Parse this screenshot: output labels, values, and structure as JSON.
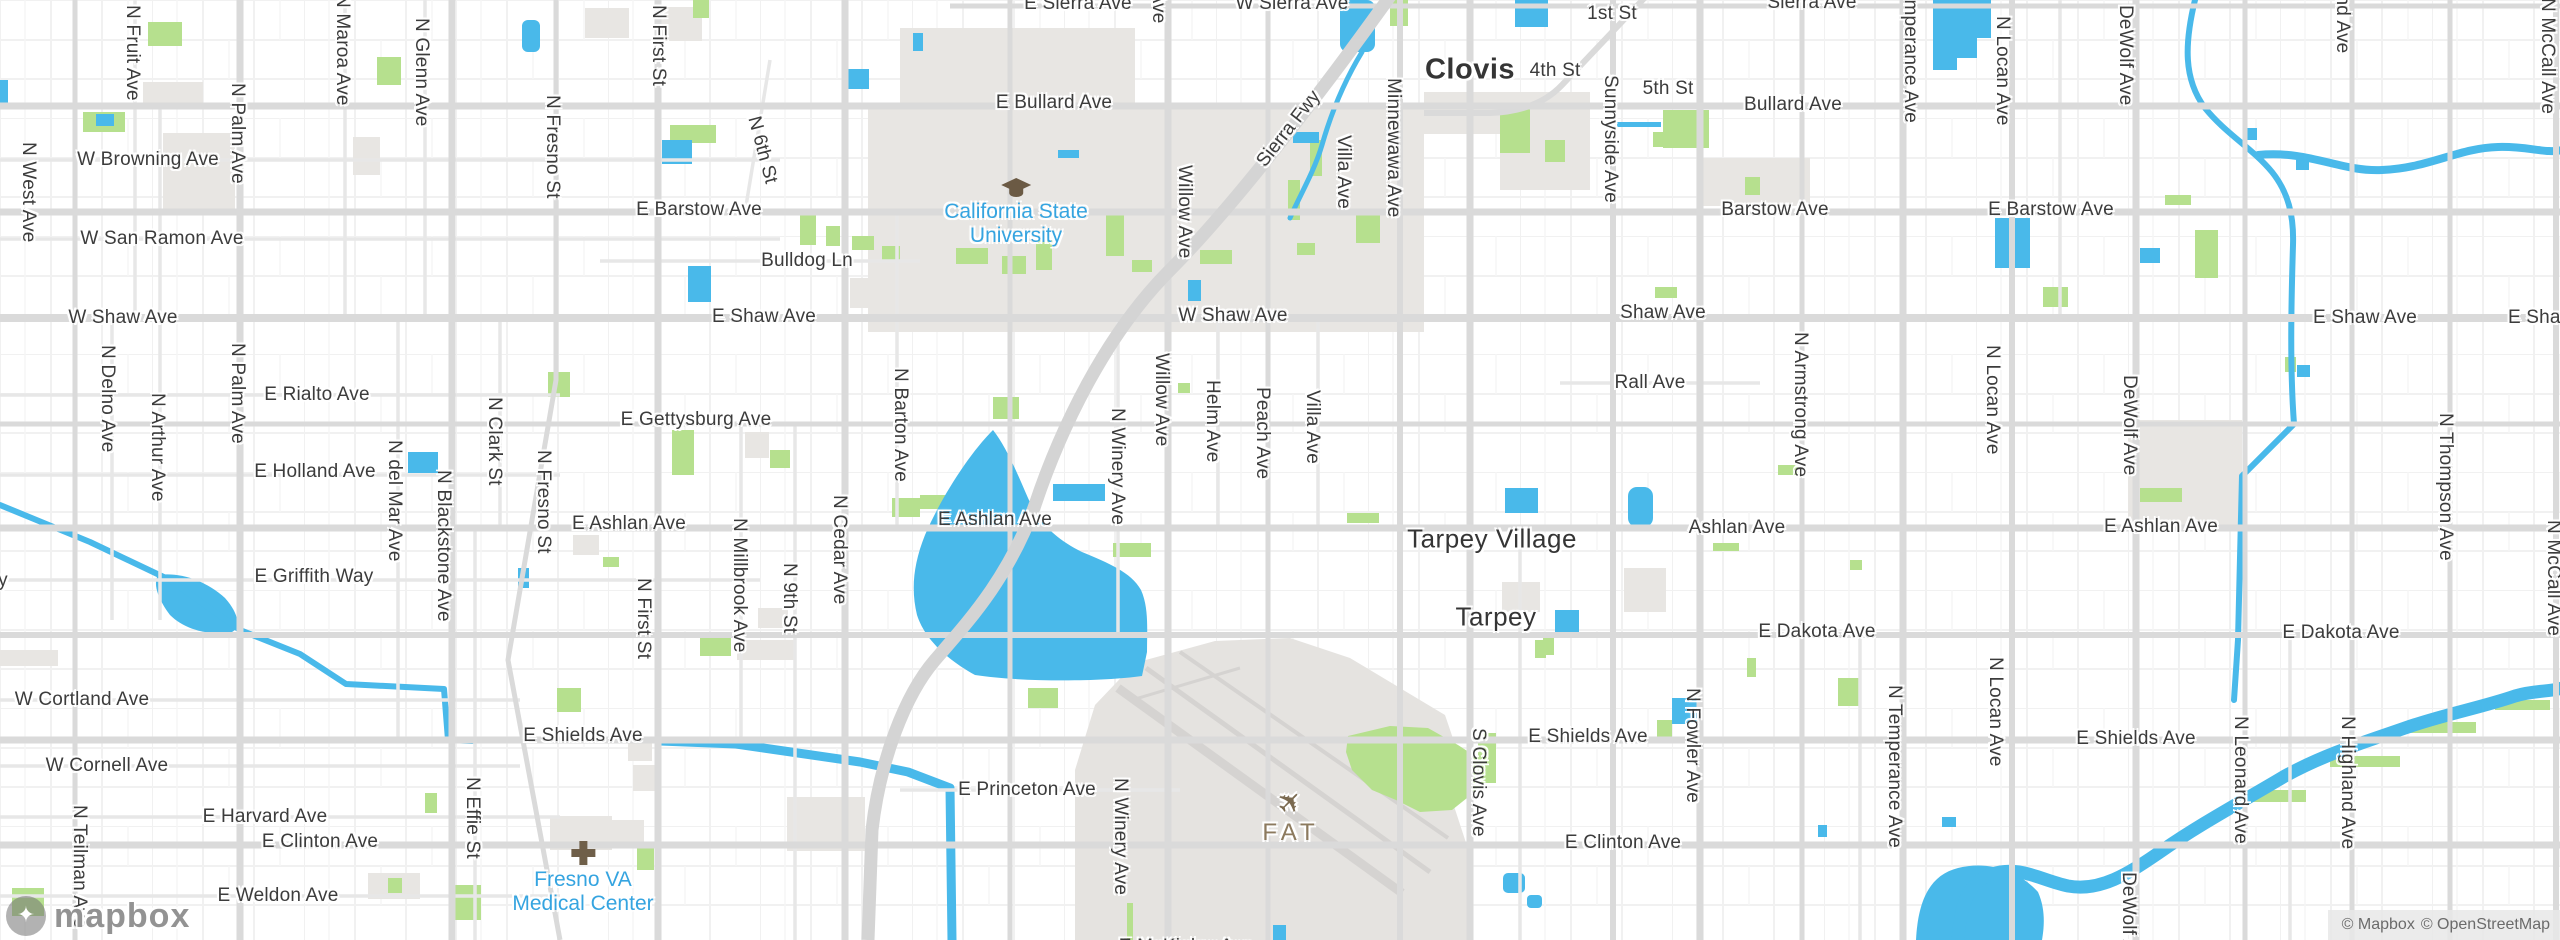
{
  "branding": {
    "logo": "mapbox"
  },
  "attribution": {
    "mapbox": "© Mapbox",
    "osm": "© OpenStreetMap"
  },
  "colors": {
    "water": "#49b9ea",
    "park": "#b6e08e",
    "urban": "#e8e6e3",
    "road_major": "#dadada",
    "road_minor": "#e9e9e9",
    "freeway": "#d4d4d4",
    "street_label": "#3c3c3c",
    "poi_blue": "#35a4e0",
    "poi_brown": "#8c7a5e"
  },
  "map": {
    "city_labels": [
      {
        "t": "Clovis",
        "x": 1470,
        "y": 70,
        "bold": true
      },
      {
        "t": "Tarpey Village",
        "x": 1492,
        "y": 539,
        "bold": false
      },
      {
        "t": "Tarpey",
        "x": 1496,
        "y": 617,
        "bold": false
      }
    ],
    "street_labels_h": [
      {
        "t": "E Sierra Ave",
        "x": 1078,
        "y": 4
      },
      {
        "t": "W Sierra Ave",
        "x": 1292,
        "y": 4
      },
      {
        "t": "Sierra Ave",
        "x": 1812,
        "y": 3
      },
      {
        "t": "1st St",
        "x": 1612,
        "y": 14
      },
      {
        "t": "4th St",
        "x": 1555,
        "y": 71
      },
      {
        "t": "5th St",
        "x": 1668,
        "y": 89
      },
      {
        "t": "E Bullard Ave",
        "x": 1054,
        "y": 103
      },
      {
        "t": "Bullard Ave",
        "x": 1793,
        "y": 105
      },
      {
        "t": "W Browning Ave",
        "x": 148,
        "y": 160
      },
      {
        "t": "E Barstow Ave",
        "x": 699,
        "y": 210
      },
      {
        "t": "Barstow Ave",
        "x": 1775,
        "y": 210
      },
      {
        "t": "E Barstow Ave",
        "x": 2051,
        "y": 210
      },
      {
        "t": "W San Ramon Ave",
        "x": 162,
        "y": 239
      },
      {
        "t": "Bulldog Ln",
        "x": 807,
        "y": 261
      },
      {
        "t": "W Shaw Ave",
        "x": 123,
        "y": 318
      },
      {
        "t": "E Shaw Ave",
        "x": 764,
        "y": 317
      },
      {
        "t": "W Shaw Ave",
        "x": 1233,
        "y": 316
      },
      {
        "t": "Shaw Ave",
        "x": 1663,
        "y": 313
      },
      {
        "t": "E Shaw Ave",
        "x": 2365,
        "y": 318
      },
      {
        "t": "E Shaw Ave",
        "x": 2560,
        "y": 318
      },
      {
        "t": "E Rialto Ave",
        "x": 317,
        "y": 395
      },
      {
        "t": "Rall Ave",
        "x": 1650,
        "y": 383
      },
      {
        "t": "E Gettysburg Ave",
        "x": 696,
        "y": 420
      },
      {
        "t": "E Holland Ave",
        "x": 315,
        "y": 472
      },
      {
        "t": "E Ashlan Ave",
        "x": 629,
        "y": 524
      },
      {
        "t": "E Ashlan Ave",
        "x": 995,
        "y": 520
      },
      {
        "t": "Ashlan Ave",
        "x": 1737,
        "y": 528
      },
      {
        "t": "E Ashlan Ave",
        "x": 2161,
        "y": 527
      },
      {
        "t": "E Griffith Way",
        "x": 314,
        "y": 577
      },
      {
        "t": "y",
        "x": 3,
        "y": 581
      },
      {
        "t": "E Dakota Ave",
        "x": 1817,
        "y": 632
      },
      {
        "t": "E Dakota Ave",
        "x": 2341,
        "y": 633
      },
      {
        "t": "W Cortland Ave",
        "x": 82,
        "y": 700
      },
      {
        "t": "E Shields Ave",
        "x": 583,
        "y": 736
      },
      {
        "t": "E Shields Ave",
        "x": 1588,
        "y": 737
      },
      {
        "t": "E Shields Ave",
        "x": 2136,
        "y": 739
      },
      {
        "t": "W Cornell Ave",
        "x": 107,
        "y": 766
      },
      {
        "t": "E Princeton Ave",
        "x": 1027,
        "y": 790
      },
      {
        "t": "E Harvard Ave",
        "x": 265,
        "y": 817
      },
      {
        "t": "E Clinton Ave",
        "x": 320,
        "y": 842
      },
      {
        "t": "E Clinton Ave",
        "x": 1623,
        "y": 843
      },
      {
        "t": "E Weldon Ave",
        "x": 278,
        "y": 896
      },
      {
        "t": "E McKinley Ave",
        "x": 1186,
        "y": 947
      }
    ],
    "street_labels_v": [
      {
        "t": "N West Ave",
        "x": 28,
        "y": 142
      },
      {
        "t": "N Fruit Ave",
        "x": 132,
        "y": 5
      },
      {
        "t": "N Palm Ave",
        "x": 237,
        "y": 83
      },
      {
        "t": "N Maroa Ave",
        "x": 342,
        "y": -6
      },
      {
        "t": "N Glenn Ave",
        "x": 421,
        "y": 18
      },
      {
        "t": "N Fresno St",
        "x": 552,
        "y": 95
      },
      {
        "t": "N First St",
        "x": 658,
        "y": 5
      },
      {
        "t": "N Delno Ave",
        "x": 107,
        "y": 345
      },
      {
        "t": "N Arthur Ave",
        "x": 157,
        "y": 393
      },
      {
        "t": "N Palm Ave",
        "x": 237,
        "y": 343
      },
      {
        "t": "N del Mar Ave",
        "x": 394,
        "y": 440
      },
      {
        "t": "N Blackstone Ave",
        "x": 443,
        "y": 470
      },
      {
        "t": "N Clark St",
        "x": 494,
        "y": 397
      },
      {
        "t": "N Fresno St",
        "x": 543,
        "y": 450
      },
      {
        "t": "N First St",
        "x": 643,
        "y": 578
      },
      {
        "t": "N Millbrook Ave",
        "x": 739,
        "y": 518
      },
      {
        "t": "N 9th St",
        "x": 789,
        "y": 563
      },
      {
        "t": "N Cedar Ave",
        "x": 839,
        "y": 495
      },
      {
        "t": "N Barton Ave",
        "x": 900,
        "y": 368
      },
      {
        "t": "N Winery Ave",
        "x": 1117,
        "y": 408
      },
      {
        "t": "N Winery Ave",
        "x": 1120,
        "y": 778
      },
      {
        "t": "Willow Ave",
        "x": 1158,
        "y": -70
      },
      {
        "t": "Willow Ave",
        "x": 1184,
        "y": 165
      },
      {
        "t": "Willow Ave",
        "x": 1161,
        "y": 353
      },
      {
        "t": "Helm Ave",
        "x": 1212,
        "y": 380
      },
      {
        "t": "Peach Ave",
        "x": 1262,
        "y": 387
      },
      {
        "t": "Villa Ave",
        "x": 1343,
        "y": 135
      },
      {
        "t": "Villa Ave",
        "x": 1312,
        "y": 390
      },
      {
        "t": "Minnewawa Ave",
        "x": 1393,
        "y": 78
      },
      {
        "t": "Sunnyside Ave",
        "x": 1610,
        "y": 75
      },
      {
        "t": "N Armstrong Ave",
        "x": 1800,
        "y": 332
      },
      {
        "t": "N Locan Ave",
        "x": 2002,
        "y": 16
      },
      {
        "t": "N Locan Ave",
        "x": 1992,
        "y": 345
      },
      {
        "t": "N Locan Ave",
        "x": 1995,
        "y": 657
      },
      {
        "t": "DeWolf Ave",
        "x": 2125,
        "y": 5
      },
      {
        "t": "DeWolf Ave",
        "x": 2129,
        "y": 375
      },
      {
        "t": "DeWolf Ave",
        "x": 2128,
        "y": 872
      },
      {
        "t": "N Temperance Ave",
        "x": 1910,
        "y": -40
      },
      {
        "t": "N Temperance Ave",
        "x": 1894,
        "y": 685
      },
      {
        "t": "N Thompson Ave",
        "x": 2445,
        "y": 413
      },
      {
        "t": "N McCall Ave",
        "x": 2547,
        "y": -2
      },
      {
        "t": "N McCall Ave",
        "x": 2553,
        "y": 520
      },
      {
        "t": "N Leonard Ave",
        "x": 2240,
        "y": 716
      },
      {
        "t": "N Highland Ave",
        "x": 2347,
        "y": 716
      },
      {
        "t": "N Highland Ave",
        "x": 2342,
        "y": -80
      },
      {
        "t": "N Fowler Ave",
        "x": 1692,
        "y": 688
      },
      {
        "t": "S Clovis Ave",
        "x": 1478,
        "y": 728
      },
      {
        "t": "N Effie St",
        "x": 472,
        "y": 777
      },
      {
        "t": "N Teilman Ave",
        "x": 79,
        "y": 805
      }
    ],
    "street_labels_diag": [
      {
        "t": "Sierra Fwy",
        "x": 1289,
        "y": 129,
        "a": -52
      },
      {
        "t": "N 6th St",
        "x": 762,
        "y": 150,
        "a": 75
      }
    ],
    "pois": [
      {
        "name": "California State University",
        "lines": [
          "California State",
          "University"
        ],
        "x": 1016,
        "y": 178,
        "icon": "graduation-cap",
        "style": "blue"
      },
      {
        "name": "Fresno VA Medical Center",
        "lines": [
          "Fresno VA",
          "Medical Center"
        ],
        "x": 583,
        "y": 840,
        "icon": "hospital-cross",
        "style": "blue"
      },
      {
        "name": "FAT",
        "lines": [
          "FAT"
        ],
        "x": 1291,
        "y": 786,
        "icon": "airplane",
        "style": "airport"
      }
    ]
  }
}
